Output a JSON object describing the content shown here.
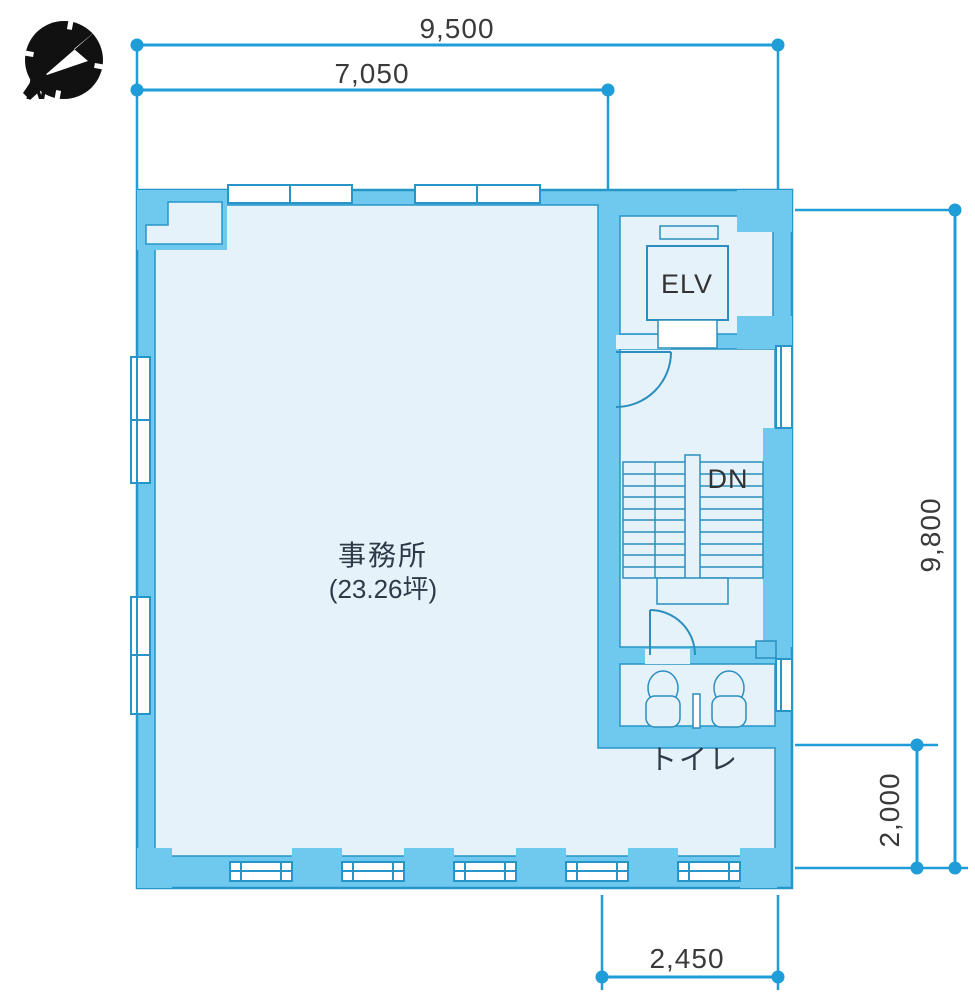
{
  "plan": {
    "title": "office floor plan",
    "compass": {
      "label": "N"
    },
    "dimensions": {
      "top_total": "9,500",
      "top_partial": "7,050",
      "right_total": "9,800",
      "right_lower": "2,000",
      "bottom_partial": "2,450"
    },
    "rooms": {
      "office": {
        "name": "事務所",
        "area": "(23.26坪)"
      },
      "elevator": {
        "label": "ELV"
      },
      "stairs": {
        "label": "DN"
      },
      "toilet": {
        "label": "トイレ"
      }
    },
    "colors": {
      "wall_fill": "#6fc8ee",
      "wall_stroke": "#2695c8",
      "room_fill": "#e6f2f9",
      "dimension_line": "#1e9dd8",
      "dimension_text": "#3a3a3a",
      "label_text": "#2e3a48",
      "compass": "#111111"
    }
  }
}
